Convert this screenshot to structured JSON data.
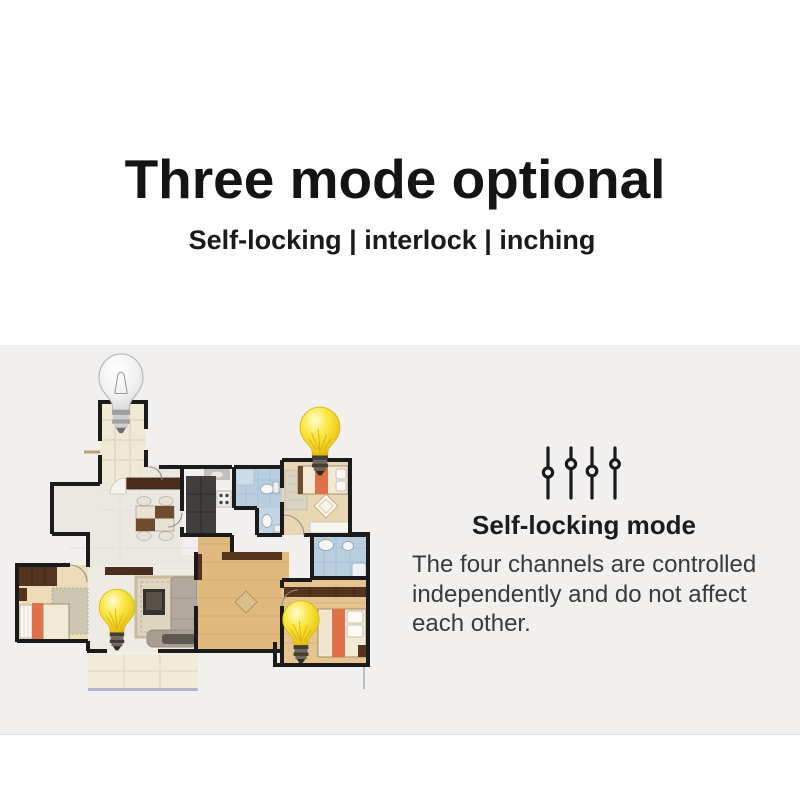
{
  "header": {
    "title": "Three mode optional",
    "subtitle": "Self-locking | interlock | inching"
  },
  "mode_panel": {
    "icon": "channel-sliders-icon",
    "heading": "Self-locking mode",
    "description": "The four channels are controlled independently and do not affect each other.",
    "description_lines": [
      "The four channels are controlled",
      "independently and do not affect",
      "each other."
    ],
    "channels": 4,
    "slider_knob_positions": [
      "low",
      "high",
      "low",
      "high"
    ]
  },
  "floor_plan": {
    "label": "apartment floor plan with light bulbs",
    "bulbs": [
      {
        "name": "foyer-bulb",
        "state": "off"
      },
      {
        "name": "bedroom-top-right-bulb",
        "state": "on"
      },
      {
        "name": "living-room-bulb",
        "state": "on"
      },
      {
        "name": "bedroom-bottom-right-bulb",
        "state": "on"
      }
    ],
    "rooms": [
      "foyer",
      "dining-area",
      "kitchen",
      "bathroom-1",
      "wc",
      "bedroom-top-right",
      "hallway",
      "bedroom-bottom-left",
      "living-room",
      "bathroom-2",
      "bedroom-bottom-right",
      "balcony"
    ]
  },
  "colors": {
    "page_background": "#ffffff",
    "band_background": "#f1f0ee",
    "title_text": "#141414",
    "body_text": "#3a3a3a",
    "bulb_on": "#f6e235",
    "bulb_off": "#f2f2f2",
    "wall": "#1b1b1b",
    "wood_floor": "#e1b97e",
    "bedroom_floor": "#eddbb9",
    "bath_tile": "#b9cede",
    "accent_orange": "#e07048",
    "dark_wood": "#54331f",
    "balcony_trim": "#b7b2cf"
  }
}
